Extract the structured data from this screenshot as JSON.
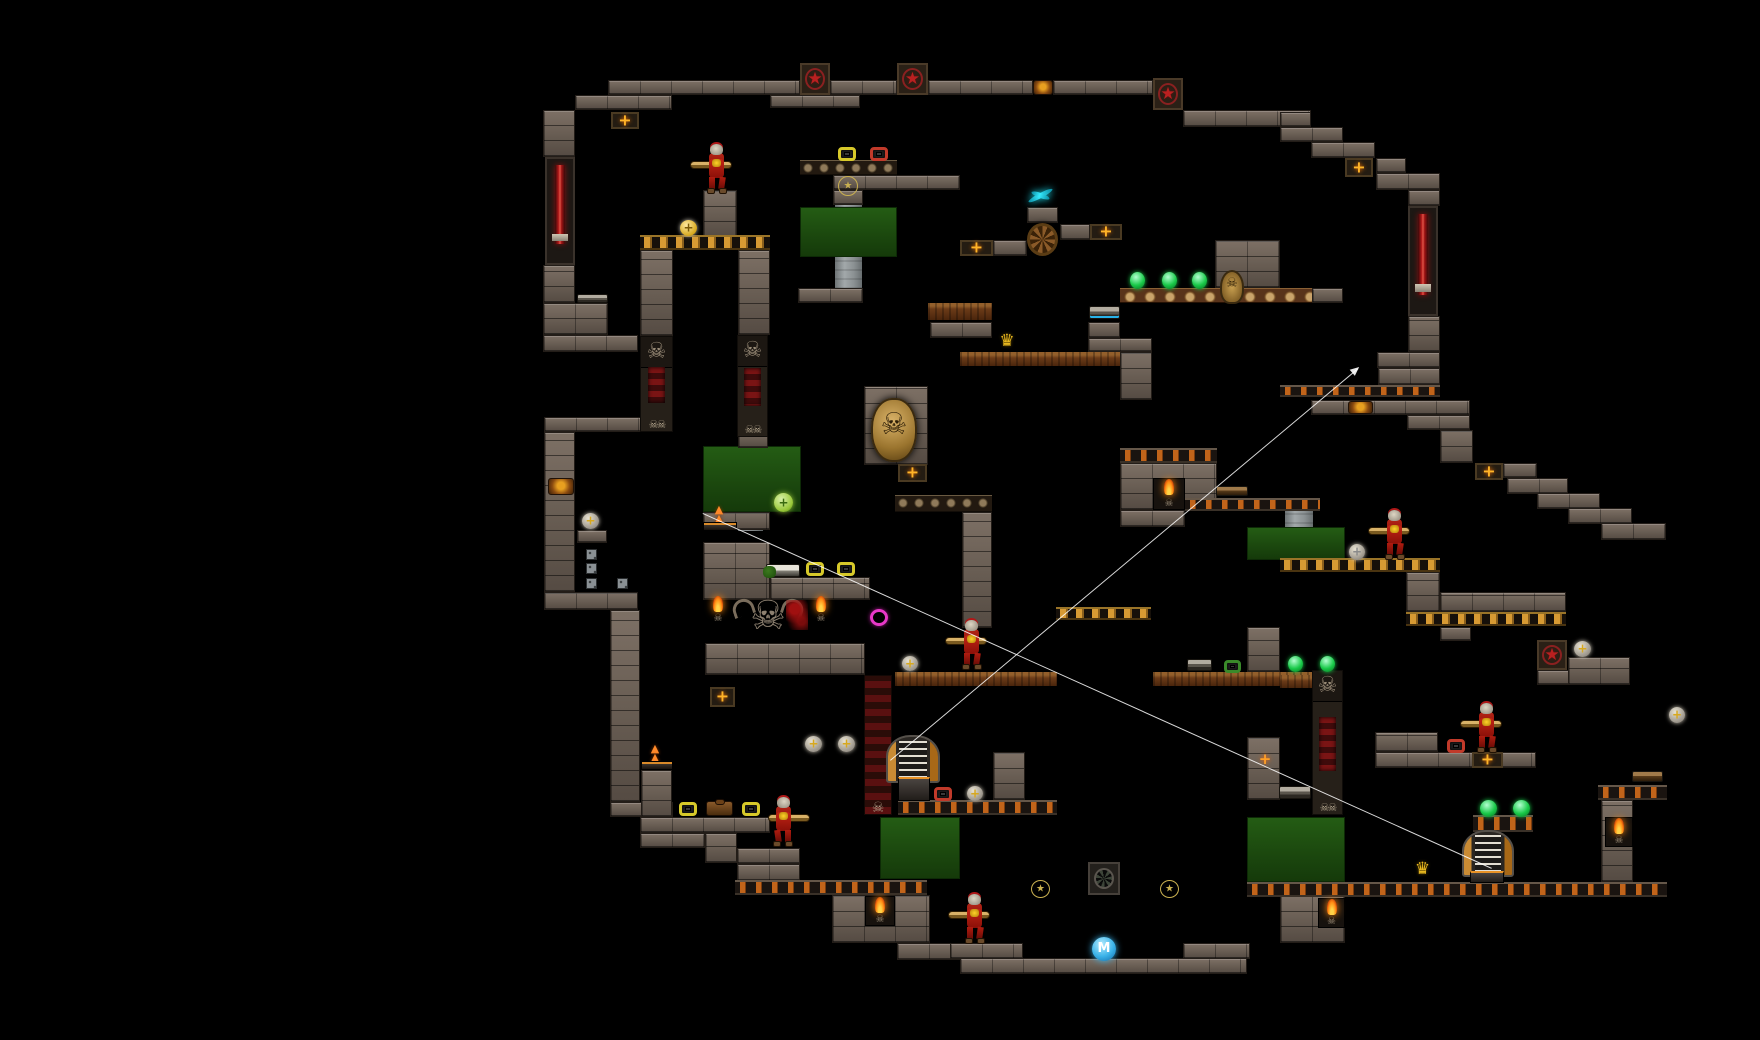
{
  "meta": {
    "canvas_w": 1760,
    "canvas_h": 1040,
    "background": "#000000"
  },
  "palette": {
    "brick": "#6f645a",
    "brick_dark": "#463f38",
    "door_green": "#1b470e",
    "shaft_grey": "#8b9193",
    "gold_floor": "#d79a33",
    "lava_floor": "#c1641a",
    "imp_red": "#c01c12",
    "line_white": "#ffffff",
    "gem_green": "#18c948",
    "sphere_blue": "#3ab2e8",
    "ring_magenta": "#e838c8",
    "flame_orange": "#ff8a12"
  },
  "sphere": {
    "label": "M",
    "x": 1092,
    "y": 937,
    "w": 24,
    "h": 24
  },
  "map": {
    "walls": [
      [
        608,
        80,
        192,
        15
      ],
      [
        830,
        80,
        67,
        15
      ],
      [
        928,
        80,
        105,
        15
      ],
      [
        1053,
        80,
        100,
        15
      ],
      [
        1183,
        110,
        128,
        17
      ],
      [
        575,
        95,
        97,
        15
      ],
      [
        543,
        110,
        32,
        47
      ],
      [
        543,
        265,
        32,
        38
      ],
      [
        543,
        303,
        65,
        32
      ],
      [
        543,
        335,
        95,
        17
      ],
      [
        544,
        417,
        126,
        15
      ],
      [
        544,
        432,
        31,
        160
      ],
      [
        577,
        530,
        30,
        13
      ],
      [
        544,
        592,
        94,
        18
      ],
      [
        610,
        610,
        30,
        192
      ],
      [
        610,
        802,
        63,
        15
      ],
      [
        641,
        770,
        31,
        47
      ],
      [
        640,
        817,
        130,
        16
      ],
      [
        640,
        833,
        65,
        15
      ],
      [
        705,
        833,
        32,
        30
      ],
      [
        737,
        848,
        63,
        16
      ],
      [
        737,
        864,
        63,
        17,
        2
      ],
      [
        832,
        895,
        98,
        48
      ],
      [
        897,
        943,
        63,
        17
      ],
      [
        950,
        943,
        73,
        16
      ],
      [
        960,
        958,
        287,
        16
      ],
      [
        1183,
        943,
        67,
        16
      ],
      [
        703,
        190,
        34,
        48
      ],
      [
        640,
        250,
        33,
        86
      ],
      [
        738,
        250,
        32,
        85
      ],
      [
        738,
        430,
        30,
        18
      ],
      [
        703,
        512,
        67,
        18
      ],
      [
        703,
        542,
        67,
        58
      ],
      [
        770,
        577,
        100,
        23
      ],
      [
        705,
        643,
        160,
        32
      ],
      [
        993,
        752,
        32,
        48
      ],
      [
        864,
        386,
        64,
        79
      ],
      [
        962,
        512,
        30,
        116
      ],
      [
        833,
        175,
        127,
        15
      ],
      [
        833,
        190,
        30,
        15
      ],
      [
        798,
        288,
        65,
        15
      ],
      [
        930,
        322,
        62,
        16,
        2
      ],
      [
        1027,
        207,
        31,
        16
      ],
      [
        1060,
        224,
        30,
        16
      ],
      [
        993,
        240,
        34,
        16
      ],
      [
        1088,
        322,
        32,
        16
      ],
      [
        1088,
        338,
        64,
        14
      ],
      [
        1120,
        352,
        32,
        48
      ],
      [
        1215,
        240,
        65,
        48
      ],
      [
        1312,
        288,
        31,
        15
      ],
      [
        1247,
        627,
        33,
        45
      ],
      [
        1247,
        737,
        33,
        63
      ],
      [
        1280,
        895,
        65,
        48
      ],
      [
        1375,
        732,
        63,
        20,
        2
      ],
      [
        1375,
        752,
        161,
        16
      ],
      [
        1537,
        670,
        61,
        15
      ],
      [
        1568,
        657,
        62,
        28
      ],
      [
        1440,
        592,
        126,
        20
      ],
      [
        1406,
        572,
        34,
        40
      ],
      [
        1440,
        627,
        31,
        14
      ],
      [
        1120,
        463,
        97,
        47
      ],
      [
        1120,
        510,
        65,
        17
      ],
      [
        1601,
        800,
        32,
        82
      ],
      [
        1280,
        112,
        31,
        15
      ],
      [
        1280,
        127,
        63,
        15
      ],
      [
        1311,
        142,
        64,
        16
      ],
      [
        1376,
        158,
        30,
        15
      ],
      [
        1376,
        173,
        64,
        17
      ],
      [
        1408,
        190,
        32,
        16
      ],
      [
        1408,
        316,
        32,
        36
      ],
      [
        1377,
        352,
        63,
        16
      ],
      [
        1378,
        368,
        62,
        17,
        2
      ],
      [
        1311,
        400,
        159,
        15
      ],
      [
        1407,
        415,
        63,
        15
      ],
      [
        1440,
        430,
        33,
        33
      ],
      [
        1503,
        463,
        34,
        15
      ],
      [
        1507,
        478,
        61,
        16
      ],
      [
        1537,
        493,
        63,
        16
      ],
      [
        1568,
        508,
        64,
        16
      ],
      [
        1601,
        523,
        65,
        17
      ],
      [
        770,
        95,
        90,
        13,
        2
      ]
    ],
    "floors": [
      [
        640,
        235,
        130,
        15,
        "g"
      ],
      [
        1280,
        558,
        160,
        14,
        "g"
      ],
      [
        1406,
        612,
        160,
        14,
        "g"
      ],
      [
        1056,
        607,
        95,
        13,
        "g"
      ],
      [
        1280,
        385,
        160,
        12,
        "l"
      ],
      [
        1185,
        498,
        135,
        13,
        "l"
      ],
      [
        1120,
        448,
        97,
        15,
        "l"
      ],
      [
        1473,
        815,
        60,
        17,
        "l"
      ],
      [
        735,
        880,
        192,
        15,
        "l"
      ],
      [
        898,
        800,
        159,
        15,
        "l"
      ],
      [
        1247,
        882,
        420,
        15,
        "l"
      ],
      [
        1598,
        785,
        69,
        15,
        "l"
      ],
      [
        800,
        160,
        97,
        15,
        "s"
      ],
      [
        895,
        495,
        97,
        17,
        "s"
      ],
      [
        1120,
        288,
        192,
        15,
        "c"
      ],
      [
        928,
        303,
        64,
        17,
        "d"
      ],
      [
        960,
        352,
        160,
        14,
        "d"
      ],
      [
        895,
        672,
        162,
        14,
        "d"
      ],
      [
        1153,
        672,
        159,
        14,
        "d"
      ],
      [
        1280,
        675,
        32,
        13,
        "d"
      ]
    ],
    "doors": [
      [
        800,
        207,
        97,
        50
      ],
      [
        703,
        446,
        98,
        66
      ],
      [
        1247,
        817,
        98,
        65
      ],
      [
        1247,
        527,
        98,
        33
      ],
      [
        880,
        817,
        80,
        62
      ]
    ],
    "shafts": [
      [
        835,
        177,
        27,
        112
      ],
      [
        738,
        446,
        25,
        85
      ],
      [
        1283,
        818,
        29,
        62
      ],
      [
        1285,
        510,
        28,
        50
      ],
      [
        898,
        818,
        27,
        60
      ]
    ],
    "pillars": [
      [
        545,
        157,
        30,
        108,
        "sword"
      ],
      [
        1408,
        206,
        30,
        110,
        "sword"
      ],
      [
        640,
        336,
        33,
        96,
        "skull"
      ],
      [
        737,
        335,
        31,
        102,
        "skull"
      ],
      [
        1312,
        670,
        31,
        145,
        "skull"
      ],
      [
        864,
        675,
        28,
        140,
        "drip"
      ]
    ],
    "decors": [
      [
        736,
        597,
        64,
        44,
        "baph"
      ],
      [
        871,
        398,
        46,
        64,
        "bigskull"
      ],
      [
        800,
        63,
        30,
        32,
        "penta"
      ],
      [
        897,
        63,
        31,
        32,
        "penta"
      ],
      [
        1153,
        78,
        30,
        32,
        "penta"
      ],
      [
        1537,
        640,
        30,
        30,
        "penta"
      ],
      [
        1033,
        80,
        20,
        15,
        "impface"
      ],
      [
        548,
        478,
        26,
        17,
        "impface"
      ],
      [
        1348,
        401,
        25,
        13,
        "impface"
      ],
      [
        1088,
        862,
        32,
        33,
        "gear"
      ],
      [
        1027,
        223,
        31,
        33,
        "wheel"
      ],
      [
        1031,
        880,
        19,
        18,
        "pcircle"
      ],
      [
        1160,
        880,
        19,
        18,
        "pcircle"
      ],
      [
        838,
        176,
        20,
        20,
        "pcircle"
      ],
      [
        1220,
        270,
        24,
        34,
        "medal"
      ],
      [
        786,
        600,
        22,
        30,
        "blood"
      ]
    ],
    "torches": [
      [
        1153,
        478,
        32,
        32,
        1
      ],
      [
        865,
        896,
        30,
        30,
        1
      ],
      [
        1318,
        898,
        27,
        30,
        1
      ],
      [
        1605,
        817,
        28,
        30,
        1
      ],
      [
        710,
        596,
        16,
        28,
        0
      ],
      [
        813,
        596,
        16,
        28,
        0
      ]
    ],
    "gates": [
      [
        886,
        735,
        54,
        48
      ],
      [
        1462,
        830,
        52,
        47
      ]
    ],
    "pedestals": [
      [
        898,
        777,
        32,
        24
      ],
      [
        1470,
        871,
        34,
        12
      ]
    ],
    "lifts": [
      {
        "ax": 709,
        "ay": 505,
        "px": 703,
        "py": 522,
        "pw": 34
      },
      {
        "ax": 645,
        "ay": 744,
        "px": 641,
        "py": 761,
        "pw": 32
      }
    ],
    "items": [
      [
        611,
        112,
        28,
        17,
        "plusblock"
      ],
      [
        1345,
        158,
        28,
        19,
        "plusblock"
      ],
      [
        898,
        464,
        29,
        18,
        "plusblock"
      ],
      [
        710,
        687,
        25,
        20,
        "plusblock"
      ],
      [
        960,
        240,
        33,
        16,
        "plusblock"
      ],
      [
        1090,
        224,
        32,
        16,
        "plusblock"
      ],
      [
        1472,
        752,
        31,
        16,
        "plusblock"
      ],
      [
        1475,
        463,
        28,
        17,
        "plusblock"
      ],
      [
        1257,
        752,
        16,
        16,
        "pluspickup"
      ],
      [
        680,
        220,
        17,
        16,
        "orbgold"
      ],
      [
        838,
        147,
        18,
        14,
        "boxy"
      ],
      [
        806,
        562,
        18,
        14,
        "boxy"
      ],
      [
        837,
        562,
        18,
        14,
        "boxy"
      ],
      [
        679,
        802,
        18,
        14,
        "boxy"
      ],
      [
        742,
        802,
        18,
        14,
        "boxy"
      ],
      [
        870,
        147,
        18,
        14,
        "boxr"
      ],
      [
        934,
        787,
        18,
        14,
        "boxr"
      ],
      [
        1447,
        739,
        18,
        14,
        "boxr"
      ],
      [
        1224,
        660,
        17,
        13,
        "boxg"
      ],
      [
        582,
        513,
        17,
        16,
        "orb"
      ],
      [
        805,
        736,
        17,
        16,
        "orb"
      ],
      [
        838,
        736,
        17,
        16,
        "orb"
      ],
      [
        902,
        656,
        16,
        15,
        "orb"
      ],
      [
        967,
        786,
        16,
        15,
        "orb"
      ],
      [
        1574,
        641,
        17,
        16,
        "orb"
      ],
      [
        1669,
        707,
        16,
        16,
        "orb"
      ],
      [
        1349,
        544,
        16,
        16,
        "orbsilver"
      ],
      [
        774,
        493,
        19,
        19,
        "orbgreen"
      ],
      [
        1130,
        272,
        15,
        17,
        "gem"
      ],
      [
        1162,
        272,
        15,
        17,
        "gem"
      ],
      [
        1192,
        272,
        15,
        17,
        "gem"
      ],
      [
        1288,
        656,
        15,
        16,
        "gem"
      ],
      [
        1320,
        656,
        15,
        16,
        "gem"
      ],
      [
        1480,
        800,
        17,
        17,
        "gem"
      ],
      [
        1513,
        800,
        17,
        17,
        "gem"
      ],
      [
        870,
        609,
        18,
        17,
        "mring"
      ],
      [
        996,
        333,
        22,
        19,
        "dhead"
      ],
      [
        1411,
        861,
        23,
        17,
        "dhead"
      ],
      [
        577,
        294,
        31,
        9,
        "shotgun"
      ],
      [
        1089,
        306,
        31,
        13,
        "rlauncher"
      ],
      [
        1216,
        486,
        32,
        10,
        "chaingun"
      ],
      [
        1632,
        771,
        31,
        11,
        "chaingun"
      ],
      [
        1187,
        659,
        25,
        12,
        "pistol"
      ],
      [
        1279,
        786,
        32,
        13,
        "pistol"
      ],
      [
        766,
        564,
        34,
        13,
        "plasma"
      ],
      [
        763,
        566,
        13,
        12,
        "plant"
      ],
      [
        706,
        801,
        27,
        15,
        "backpack"
      ],
      [
        586,
        549,
        11,
        11,
        "switch"
      ],
      [
        586,
        563,
        11,
        11,
        "switch"
      ],
      [
        586,
        578,
        11,
        11,
        "switch"
      ],
      [
        617,
        578,
        11,
        11,
        "switch"
      ],
      [
        1024,
        184,
        32,
        20,
        "bird"
      ]
    ],
    "enemies": [
      {
        "x": 698,
        "y": 144,
        "dir": "left"
      },
      {
        "x": 953,
        "y": 620,
        "dir": "left"
      },
      {
        "x": 764,
        "y": 797,
        "dir": "right"
      },
      {
        "x": 1376,
        "y": 510,
        "dir": "left"
      },
      {
        "x": 1468,
        "y": 703,
        "dir": "left"
      },
      {
        "x": 956,
        "y": 894,
        "dir": "left"
      }
    ],
    "links": [
      {
        "x1": 703,
        "y1": 513,
        "x2": 1492,
        "y2": 868,
        "arrow": false
      },
      {
        "x1": 890,
        "y1": 760,
        "x2": 1358,
        "y2": 368,
        "arrow": true
      }
    ]
  }
}
